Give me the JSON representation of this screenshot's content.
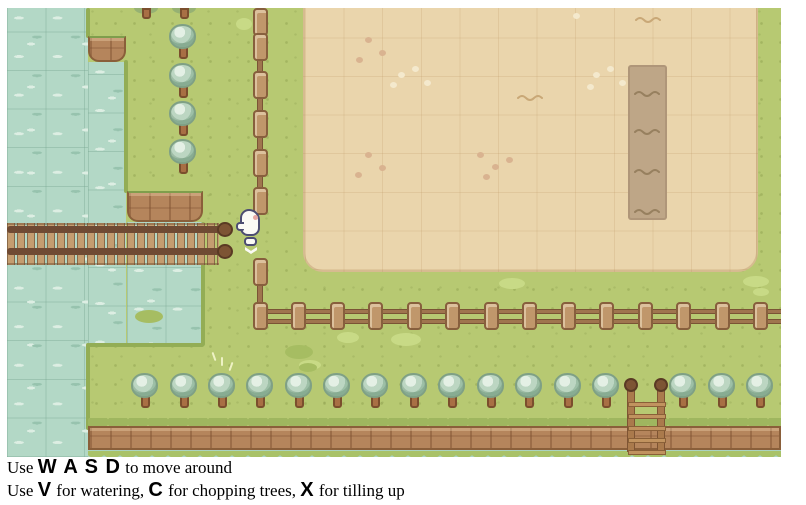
{
  "page": {
    "background_color": "#ffffff"
  },
  "instructions": {
    "lines": [
      {
        "segments": [
          {
            "t": "Use ",
            "k": "text"
          },
          {
            "t": "W A S D",
            "k": "key"
          },
          {
            "t": " to move around",
            "k": "text"
          }
        ]
      },
      {
        "segments": [
          {
            "t": "Use ",
            "k": "text"
          },
          {
            "t": "V",
            "k": "key"
          },
          {
            "t": " for watering, ",
            "k": "text"
          },
          {
            "t": "C",
            "k": "key"
          },
          {
            "t": " for chopping trees, ",
            "k": "text"
          },
          {
            "t": "X",
            "k": "key"
          },
          {
            "t": " for tilling up",
            "k": "text"
          }
        ]
      }
    ]
  },
  "game": {
    "viewport": {
      "x": 7,
      "y": 8,
      "width": 774,
      "height": 449
    },
    "palette": {
      "grass": "#b7c972",
      "water": "#b3d8c6",
      "field_dirt": "#ead5ac",
      "tilled_soil": "#bea687",
      "cliff": "#b5855c",
      "fence_wood": "#c0976b",
      "tree_canopy": "#bcd6c2",
      "tree_trunk": "#a86f44",
      "character_body": "#fbfaf5",
      "character_outline": "#4d4d72"
    },
    "sprites": {
      "trees_bottom": {
        "top": 365,
        "lefts": [
          124,
          163,
          201,
          239,
          278,
          316,
          354,
          393,
          431,
          470,
          508,
          547,
          585,
          662,
          701,
          739
        ]
      },
      "trees_left": {
        "left": 162,
        "tops": [
          16,
          55,
          93,
          131
        ]
      },
      "tree_stubs_top": {
        "centers": [
          139,
          177
        ]
      },
      "fence_h_posts": {
        "y": 294,
        "xs": [
          246,
          284,
          323,
          361,
          400,
          438,
          477,
          515,
          554,
          592,
          631,
          669,
          708,
          746
        ]
      },
      "fence_v_posts": {
        "x": 246,
        "tops": [
          0,
          25,
          63,
          102,
          141,
          179,
          250
        ]
      },
      "pink_speckles": [
        [
          358,
          29
        ],
        [
          372,
          42
        ],
        [
          349,
          49
        ],
        [
          358,
          144
        ],
        [
          372,
          157
        ],
        [
          348,
          164
        ],
        [
          470,
          144
        ],
        [
          485,
          156
        ],
        [
          499,
          149
        ],
        [
          476,
          166
        ]
      ],
      "light_speckles": [
        [
          391,
          64
        ],
        [
          405,
          58
        ],
        [
          417,
          72
        ],
        [
          383,
          74
        ],
        [
          586,
          64
        ],
        [
          600,
          58
        ],
        [
          612,
          72
        ],
        [
          580,
          76
        ],
        [
          566,
          5
        ]
      ],
      "patches_light": [
        [
          330,
          324,
          22,
          11
        ],
        [
          384,
          325,
          30,
          13
        ],
        [
          492,
          270,
          26,
          11
        ],
        [
          736,
          268,
          26,
          11
        ],
        [
          746,
          280,
          16,
          8
        ],
        [
          229,
          10,
          16,
          12
        ],
        [
          292,
          352,
          22,
          10
        ]
      ],
      "patches_dark": [
        [
          278,
          337,
          28,
          14
        ],
        [
          292,
          355,
          18,
          9
        ],
        [
          128,
          302,
          28,
          13
        ]
      ],
      "hay_strokes": [
        [
          206,
          344
        ],
        [
          214,
          349
        ],
        [
          223,
          354
        ]
      ],
      "field_tildes": [
        [
          628,
          2
        ],
        [
          510,
          80
        ]
      ],
      "soil_tildes": [
        [
          627,
          76
        ],
        [
          627,
          114
        ],
        [
          627,
          154
        ],
        [
          627,
          194
        ]
      ],
      "grass_fringes": [
        [
          79,
          0,
          4,
          30
        ],
        [
          117,
          52,
          4,
          133
        ],
        [
          194,
          214,
          4,
          124
        ],
        [
          81,
          335,
          116,
          4
        ],
        [
          79,
          335,
          4,
          87
        ]
      ]
    }
  }
}
